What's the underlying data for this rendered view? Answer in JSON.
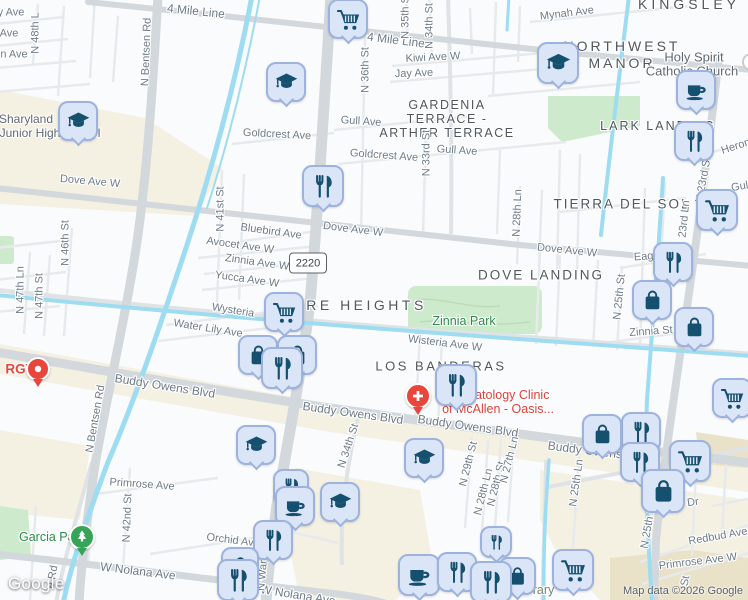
{
  "map": {
    "logo": {
      "text": "Google"
    },
    "attribution": {
      "text": "Map data ©2026 Google"
    },
    "shield": {
      "text": "2220"
    },
    "colors": {
      "marker_fill": "#dbe5f8",
      "marker_border": "#9db3de",
      "marker_icon": "#15506f",
      "water": "#9edcf2",
      "park_fill": "#cdeacc",
      "land_beige": "#f4f0e2",
      "road_major": "#d3d8dc",
      "road_minor": "#e7eaec",
      "label_street": "#6d7b88",
      "label_neighborhood": "#4f575d",
      "label_park_green": "#2c8a49",
      "label_poi_red": "#d9423a",
      "red_marker": "#e8453b",
      "green_marker": "#35a457"
    },
    "icons": {
      "cart": "shopping-cart-icon",
      "rest": "fork-knife-icon",
      "grad": "graduation-cap-icon",
      "coffee": "coffee-cup-icon",
      "bag": "shopping-bag-icon",
      "med": "medical-cross-icon",
      "tree": "pine-tree-icon",
      "dot": "location-dot-icon"
    },
    "labels": [
      {
        "t": "y Ave",
        "x": 11,
        "y": 13
      },
      {
        "t": "Ave",
        "x": 9,
        "y": 34
      },
      {
        "t": "n Ave",
        "x": 14,
        "y": 55
      },
      {
        "t": "N 48th L",
        "x": 36,
        "y": 33,
        "r": -90
      },
      {
        "t": "4 Mile Line",
        "x": 196,
        "y": 11,
        "r": 6,
        "fs": 12
      },
      {
        "t": "4 Mile Line",
        "x": 396,
        "y": 40,
        "r": 7,
        "fs": 12
      },
      {
        "t": "Mynah Ave",
        "x": 567,
        "y": 14,
        "r": -7
      },
      {
        "t": "Kiwi Ave W",
        "x": 433,
        "y": 58,
        "r": -3
      },
      {
        "t": "Jay Ave",
        "x": 414,
        "y": 74,
        "r": -2
      },
      {
        "t": "N 36th St",
        "x": 366,
        "y": 70,
        "r": -90
      },
      {
        "t": "N 34th St",
        "x": 430,
        "y": 26,
        "r": -90
      },
      {
        "t": "N 35th St",
        "x": 406,
        "y": 16,
        "r": -90
      },
      {
        "t": "N 33rd St",
        "x": 427,
        "y": 153,
        "r": -90
      },
      {
        "t": "N 28th Ln",
        "x": 518,
        "y": 213,
        "r": -88
      },
      {
        "t": "N Bentsen Rd",
        "x": 147,
        "y": 52,
        "r": -88
      },
      {
        "t": "N Bentsen Rd",
        "x": 96,
        "y": 419,
        "r": -80
      },
      {
        "t": "N 47th Ln",
        "x": 21,
        "y": 290,
        "r": -90
      },
      {
        "t": "N 47th St",
        "x": 40,
        "y": 296,
        "r": -90
      },
      {
        "t": "N 46th St",
        "x": 66,
        "y": 243,
        "r": -90
      },
      {
        "t": "N 41st St",
        "x": 221,
        "y": 209,
        "r": -90
      },
      {
        "t": "N 42nd St",
        "x": 128,
        "y": 518,
        "r": -88
      },
      {
        "t": "Goldcrest Ave",
        "x": 277,
        "y": 135,
        "r": 3
      },
      {
        "t": "Goldcrest Ave",
        "x": 384,
        "y": 156,
        "r": 4
      },
      {
        "t": "Gull Ave",
        "x": 361,
        "y": 122,
        "r": 4
      },
      {
        "t": "Gull Ave",
        "x": 457,
        "y": 151,
        "r": 4
      },
      {
        "t": "Dove Ave W",
        "x": 90,
        "y": 182,
        "r": 5
      },
      {
        "t": "Dove Ave W",
        "x": 353,
        "y": 230,
        "r": 7
      },
      {
        "t": "Dove Ave W",
        "x": 567,
        "y": 251,
        "r": 6
      },
      {
        "t": "Bluebird Ave",
        "x": 271,
        "y": 232,
        "r": 8
      },
      {
        "t": "Avocet Ave W",
        "x": 240,
        "y": 246,
        "r": 8
      },
      {
        "t": "Zinnia Ave W",
        "x": 257,
        "y": 263,
        "r": 8
      },
      {
        "t": "Yucca Ave W",
        "x": 247,
        "y": 280,
        "r": 8
      },
      {
        "t": "Wysteria",
        "x": 233,
        "y": 311,
        "r": 9
      },
      {
        "t": "Water Lily Ave",
        "x": 208,
        "y": 329,
        "r": 9
      },
      {
        "t": "Wisteria Ave W",
        "x": 445,
        "y": 344,
        "r": 7
      },
      {
        "t": "Buddy Owens Blvd",
        "x": 165,
        "y": 386,
        "r": 9,
        "fs": 12
      },
      {
        "t": "Buddy Owens Blvd",
        "x": 353,
        "y": 413,
        "r": 8,
        "fs": 12
      },
      {
        "t": "Buddy Owens Blvd",
        "x": 468,
        "y": 426,
        "r": 8,
        "fs": 12
      },
      {
        "t": "Buddy Owens",
        "x": 585,
        "y": 450,
        "r": 7,
        "fs": 12
      },
      {
        "t": "W Nolana Ave",
        "x": 138,
        "y": 571,
        "r": 7,
        "fs": 12
      },
      {
        "t": "W Nolana Ave",
        "x": 298,
        "y": 595,
        "r": 9,
        "fs": 12
      },
      {
        "t": "Primrose Ave",
        "x": 142,
        "y": 485,
        "r": 4
      },
      {
        "t": "Orchid Ave",
        "x": 233,
        "y": 541,
        "r": 7
      },
      {
        "t": "Redbud Ave",
        "x": 718,
        "y": 537,
        "r": -10
      },
      {
        "t": "Primrose Ave W",
        "x": 698,
        "y": 562,
        "r": -7
      },
      {
        "t": "Dr",
        "x": 693,
        "y": 503,
        "r": -8
      },
      {
        "t": "N 34th St",
        "x": 349,
        "y": 446,
        "r": -72
      },
      {
        "t": "N 29th St",
        "x": 469,
        "y": 464,
        "r": -76
      },
      {
        "t": "N 28th Ln",
        "x": 484,
        "y": 492,
        "r": -76
      },
      {
        "t": "N 28th St",
        "x": 497,
        "y": 484,
        "r": -76
      },
      {
        "t": "N 27th Ln",
        "x": 510,
        "y": 460,
        "r": -76
      },
      {
        "t": "N 25th Ln",
        "x": 577,
        "y": 483,
        "r": -82
      },
      {
        "t": "N 25th St",
        "x": 620,
        "y": 297,
        "r": -84
      },
      {
        "t": "N 25th St",
        "x": 649,
        "y": 526,
        "r": -80
      },
      {
        "t": "N 23rd St",
        "x": 704,
        "y": 180,
        "r": -80
      },
      {
        "t": "23rd Ln",
        "x": 685,
        "y": 219,
        "r": -84
      },
      {
        "t": "Heron",
        "x": 736,
        "y": 147,
        "r": -18
      },
      {
        "t": "Gull",
        "x": 741,
        "y": 187,
        "r": -10
      },
      {
        "t": "Eagle",
        "x": 648,
        "y": 257,
        "r": -4
      },
      {
        "t": "Zinnia St",
        "x": 651,
        "y": 332,
        "r": -4
      },
      {
        "t": "e Rd",
        "x": 53,
        "y": 577,
        "r": -80
      },
      {
        "t": "N Ware Rd",
        "x": 264,
        "y": 564,
        "r": -85
      },
      {
        "t": "St",
        "x": 686,
        "y": 581,
        "r": -80
      },
      {
        "t": "NORTHWEST",
        "x": 622,
        "y": 46,
        "cls": "neigh",
        "fs": 14,
        "ls": 3
      },
      {
        "t": "MANOR",
        "x": 622,
        "y": 63,
        "cls": "neigh",
        "fs": 14,
        "ls": 3
      },
      {
        "t": "KINGSLEY",
        "x": 689,
        "y": 4,
        "cls": "neigh",
        "fs": 14,
        "ls": 4
      },
      {
        "t": "GARDENIA",
        "x": 447,
        "y": 105,
        "cls": "neigh",
        "fs": 12.5,
        "ls": 1.5
      },
      {
        "t": "TERRACE -",
        "x": 447,
        "y": 119,
        "cls": "neigh",
        "fs": 12.5,
        "ls": 1.5
      },
      {
        "t": "ARTHER TERRACE",
        "x": 447,
        "y": 133,
        "cls": "neigh",
        "fs": 12.5,
        "ls": 1.5
      },
      {
        "t": "LARK LANDING",
        "x": 658,
        "y": 126,
        "cls": "neigh",
        "fs": 12.5,
        "ls": 2
      },
      {
        "t": "TIERRA DEL SOL",
        "x": 622,
        "y": 204,
        "cls": "neigh",
        "fs": 13.5,
        "ls": 2
      },
      {
        "t": "DOVE LANDING",
        "x": 541,
        "y": 275,
        "cls": "neigh",
        "fs": 13.5,
        "ls": 2
      },
      {
        "t": "WARE HEIGHTS",
        "x": 352,
        "y": 305,
        "cls": "neigh",
        "fs": 14,
        "ls": 3.5
      },
      {
        "t": "LOS BANDERAS",
        "x": 441,
        "y": 366,
        "cls": "neigh",
        "fs": 13,
        "ls": 2.5
      },
      {
        "t": "Sharyland",
        "x": 26,
        "y": 119,
        "cls": "poi",
        "n": "school-name-label"
      },
      {
        "t": "Junior High School",
        "x": 50,
        "y": 133,
        "cls": "poi",
        "n": "school-name-label"
      },
      {
        "t": "Holy Spirit",
        "x": 694,
        "y": 57,
        "cls": "poi",
        "fs": 13,
        "n": "church-name-label"
      },
      {
        "t": "Catholic Church",
        "x": 692,
        "y": 71,
        "cls": "poi",
        "fs": 13,
        "n": "church-name-label"
      },
      {
        "t": "Zinnia Park",
        "x": 464,
        "y": 321,
        "cls": "park",
        "n": "park-name-label"
      },
      {
        "t": "Garcia Park",
        "x": 52,
        "y": 537,
        "cls": "park",
        "n": "park-name-label"
      },
      {
        "t": "brary",
        "x": 540,
        "y": 590,
        "cls": "lib",
        "n": "library-name-label"
      },
      {
        "t": "Dermatology Clinic",
        "x": 497,
        "y": 395,
        "cls": "red",
        "fs": 12.5,
        "n": "clinic-name-label"
      },
      {
        "t": "of McAllen - Oasis...",
        "x": 498,
        "y": 409,
        "cls": "red",
        "fs": 12.5,
        "n": "clinic-name-label"
      },
      {
        "t": "RGV",
        "x": 20,
        "y": 369,
        "cls": "redb",
        "fs": 13.5,
        "n": "hospital-name-label"
      }
    ],
    "markers": [
      {
        "ic": "cart",
        "x": 348,
        "y": 19,
        "s": 40
      },
      {
        "ic": "grad",
        "x": 286,
        "y": 82,
        "s": 40
      },
      {
        "ic": "grad",
        "x": 78,
        "y": 121,
        "s": 40
      },
      {
        "ic": "grad",
        "x": 558,
        "y": 63,
        "s": 42
      },
      {
        "ic": "coffee",
        "x": 696,
        "y": 90,
        "s": 40
      },
      {
        "ic": "rest",
        "x": 694,
        "y": 141,
        "s": 40
      },
      {
        "ic": "rest",
        "x": 323,
        "y": 186,
        "s": 42
      },
      {
        "ic": "cart",
        "x": 717,
        "y": 210,
        "s": 42
      },
      {
        "ic": "rest",
        "x": 673,
        "y": 262,
        "s": 40
      },
      {
        "ic": "bag",
        "x": 652,
        "y": 300,
        "s": 40
      },
      {
        "ic": "bag",
        "x": 694,
        "y": 327,
        "s": 40
      },
      {
        "ic": "cart",
        "x": 732,
        "y": 398,
        "s": 40
      },
      {
        "ic": "cart",
        "x": 284,
        "y": 312,
        "s": 40
      },
      {
        "ic": "bag",
        "x": 258,
        "y": 355,
        "s": 40
      },
      {
        "ic": "bag",
        "x": 297,
        "y": 355,
        "s": 40
      },
      {
        "ic": "rest",
        "x": 282,
        "y": 368,
        "s": 42
      },
      {
        "ic": "rest",
        "x": 456,
        "y": 385,
        "s": 42
      },
      {
        "ic": "med",
        "x": 418,
        "y": 396,
        "s": 26,
        "type": "red"
      },
      {
        "ic": "dot",
        "x": 38,
        "y": 369,
        "s": 24,
        "type": "red"
      },
      {
        "ic": "tree",
        "x": 82,
        "y": 537,
        "s": 26,
        "type": "green"
      },
      {
        "ic": "grad",
        "x": 256,
        "y": 445,
        "s": 40
      },
      {
        "ic": "rest",
        "x": 291,
        "y": 487,
        "s": 36
      },
      {
        "ic": "coffee",
        "x": 295,
        "y": 506,
        "s": 40
      },
      {
        "ic": "grad",
        "x": 340,
        "y": 502,
        "s": 40
      },
      {
        "ic": "grad",
        "x": 424,
        "y": 458,
        "s": 40
      },
      {
        "ic": "rest",
        "x": 273,
        "y": 540,
        "s": 40
      },
      {
        "ic": "bag",
        "x": 240,
        "y": 566,
        "s": 38
      },
      {
        "ic": "rest",
        "x": 238,
        "y": 580,
        "s": 42
      },
      {
        "ic": "rest",
        "x": 496,
        "y": 542,
        "s": 32
      },
      {
        "ic": "coffee",
        "x": 419,
        "y": 575,
        "s": 42
      },
      {
        "ic": "rest",
        "x": 457,
        "y": 572,
        "s": 40
      },
      {
        "ic": "bag",
        "x": 517,
        "y": 576,
        "s": 38
      },
      {
        "ic": "rest",
        "x": 491,
        "y": 582,
        "s": 42
      },
      {
        "ic": "cart",
        "x": 573,
        "y": 570,
        "s": 42
      },
      {
        "ic": "rest",
        "x": 641,
        "y": 432,
        "s": 40
      },
      {
        "ic": "bag",
        "x": 602,
        "y": 434,
        "s": 40
      },
      {
        "ic": "rest",
        "x": 640,
        "y": 462,
        "s": 40
      },
      {
        "ic": "cart",
        "x": 690,
        "y": 461,
        "s": 42
      },
      {
        "ic": "bag",
        "x": 663,
        "y": 491,
        "s": 44
      }
    ]
  }
}
